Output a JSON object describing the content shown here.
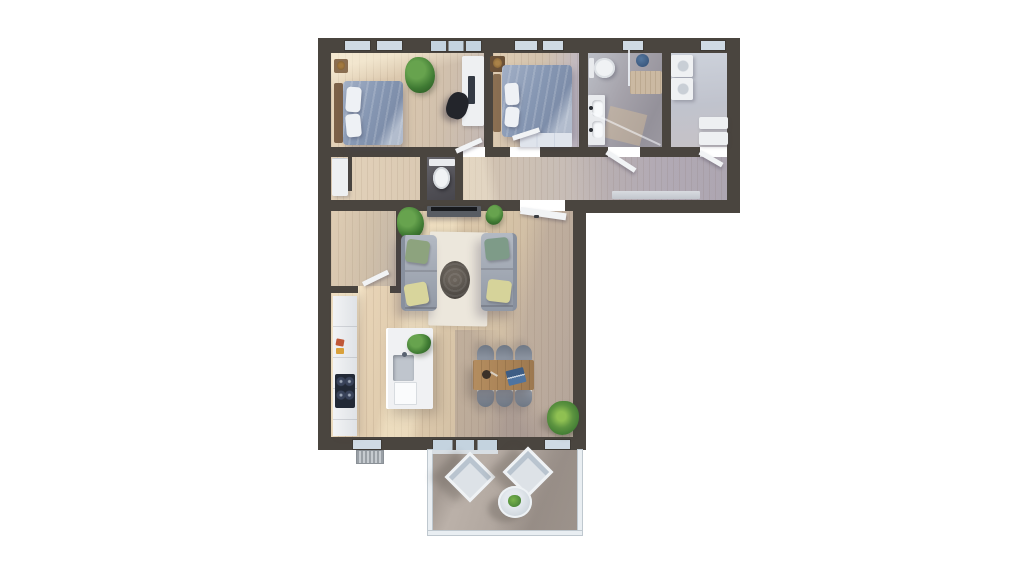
{
  "scene": {
    "type": "3D rendered apartment floor plan, top-down view",
    "background": "#ffffff"
  },
  "palette": {
    "wall": "#4a453f",
    "wood": "#dcc8ad",
    "woodLight": "#f1e3c8",
    "woodShadow": "#bfb6bb",
    "glass": "#cfdae4",
    "tileBath": "#9d9ba3",
    "tileWc": "#55545a",
    "concrete": "#b2a8a0",
    "duvet": "#8697b3",
    "sofa": "#9aa2af",
    "rug": "#ebe5d9",
    "tableWood": "#ab8a5e",
    "chairGray": "#848b97",
    "plantGreen": "#4e8a3c",
    "pillowGreen": "#8ca37f",
    "pillowYellow": "#d8d49b",
    "cooktop": "#222936",
    "laptopBlue": "#4f74a0",
    "counterWhite": "#edeff1",
    "bathBeige": "#cbb9a2",
    "stoolBlue": "#3c5a80"
  },
  "rooms": [
    {
      "id": "bedroom-1",
      "furniture": [
        "double-bed",
        "pillows",
        "headboard",
        "nightstand",
        "potted-plant",
        "desk",
        "monitor",
        "office-chair",
        "door-leaf"
      ]
    },
    {
      "id": "bedroom-2",
      "furniture": [
        "double-bed",
        "pillows",
        "side-bench",
        "plant-stand",
        "wardrobe",
        "door-leaf"
      ]
    },
    {
      "id": "bathroom",
      "furniture": [
        "toilet",
        "double-vanity",
        "shower-screen",
        "shower-tray",
        "blue-stool",
        "bath-mat"
      ]
    },
    {
      "id": "utility-room",
      "furniture": [
        "washer",
        "dryer",
        "shelves",
        "door-leaf"
      ]
    },
    {
      "id": "hallway",
      "furniture": [
        "entrance-closet",
        "sideboard",
        "door-leaf"
      ]
    },
    {
      "id": "wc",
      "furniture": [
        "toilet"
      ]
    },
    {
      "id": "storage-room",
      "furniture": [
        "door-leaf"
      ]
    },
    {
      "id": "living-room",
      "furniture": [
        "tv-bench",
        "tv",
        "sofa-left",
        "sofa-right",
        "coffee-table",
        "rug",
        "green-cushions",
        "yellow-cushions",
        "potted-plants",
        "door-leaf"
      ]
    },
    {
      "id": "kitchen",
      "furniture": [
        "counter",
        "cooktop",
        "island",
        "island-sink",
        "island-plant",
        "radiator",
        "window"
      ]
    },
    {
      "id": "dining-area",
      "furniture": [
        "dining-table",
        "chairs-x6",
        "laptop",
        "bowl",
        "potted-plant"
      ]
    },
    {
      "id": "balcony",
      "furniture": [
        "lounge-chair",
        "lounge-chair",
        "round-table",
        "table-plant",
        "glass-railing",
        "sliding-door"
      ]
    }
  ]
}
